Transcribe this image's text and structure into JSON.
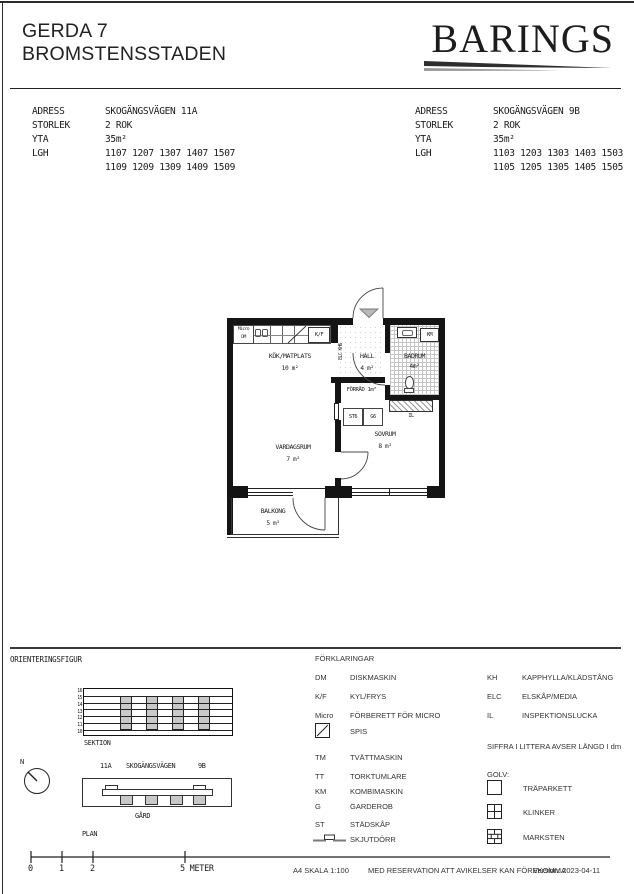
{
  "header": {
    "title_line1": "GERDA 7",
    "title_line2": "BROMSTENSSTADEN",
    "brand": "BARINGS"
  },
  "field_labels": {
    "address": "ADRESS",
    "size": "STORLEK",
    "area": "YTA",
    "apartments": "LGH"
  },
  "units": [
    {
      "address": "SKOGÄNGSVÄGEN 11A",
      "size": "2 ROK",
      "area": "35m²",
      "lgh_row1": "1107 1207 1307 1407 1507",
      "lgh_row2": "1109 1209 1309 1409 1509"
    },
    {
      "address": "SKOGÄNGSVÄGEN 9B",
      "size": "2 ROK",
      "area": "35m²",
      "lgh_row1": "1103 1203 1303 1403 1503",
      "lgh_row2": "1105 1205 1305 1405 1505"
    }
  ],
  "plan": {
    "rooms": [
      {
        "name": "KÖK/MATPLATS",
        "area": "10 m²"
      },
      {
        "name": "HALL",
        "area": "4 m²"
      },
      {
        "name": "BADRUM",
        "area": "4m²"
      },
      {
        "name": "FÖRRÅD",
        "area": "1m²"
      },
      {
        "name": "SOVRUM",
        "area": "8 m²"
      },
      {
        "name": "VARDAGSRUM",
        "area": "7 m²"
      },
      {
        "name": "BALKONG",
        "area": "5 m²"
      }
    ],
    "fixtures": {
      "micro": "Micro",
      "dm": "DM",
      "kf": "K/F",
      "elc_kh": "ELC KH6",
      "km": "KM",
      "st": "ST6",
      "g": "G6",
      "il": "IL"
    }
  },
  "orientation": {
    "title": "ORIENTERINGSFIGUR",
    "sektion_label": "SEKTION",
    "floors": [
      "16",
      "15",
      "14",
      "13",
      "12",
      "11",
      "10"
    ],
    "plan_label": "PLAN",
    "north": "N",
    "street": "SKOGÄNGSVÄGEN",
    "entrance_left": "11A",
    "entrance_right": "9B",
    "yard": "GÅRD"
  },
  "legend": {
    "title": "FÖRKLARINGAR",
    "items_left": [
      {
        "code": "DM",
        "desc": "DISKMASKIN"
      },
      {
        "code": "K/F",
        "desc": "KYL/FRYS"
      },
      {
        "code": "Micro",
        "desc": "FÖRBERETT FÖR MICRO"
      },
      {
        "code": "",
        "desc": "SPIS"
      },
      {
        "code": "TM",
        "desc": "TVÄTTMASKIN"
      },
      {
        "code": "TT",
        "desc": "TORKTUMLARE"
      },
      {
        "code": "KM",
        "desc": "KOMBIMASKIN"
      },
      {
        "code": "G",
        "desc": "GARDEROB"
      },
      {
        "code": "ST",
        "desc": "STÄDSKÅP"
      },
      {
        "code": "",
        "desc": "SKJUTDÖRR"
      }
    ],
    "items_right": [
      {
        "code": "KH",
        "desc": "KAPPHYLLA/KLÄDSTÅNG"
      },
      {
        "code": "ELC",
        "desc": "ELSKÅP/MEDIA"
      },
      {
        "code": "IL",
        "desc": "INSPEKTIONSLUCKA"
      }
    ],
    "note": "SIFFRA I LITTERA AVSER LÄNGD I dm",
    "floor_title": "GOLV:",
    "floor_types": [
      {
        "name": "TRÄPARKETT"
      },
      {
        "name": "KLINKER"
      },
      {
        "name": "MARKSTEN"
      }
    ]
  },
  "footer": {
    "scale_ticks": [
      "0",
      "1",
      "2"
    ],
    "scale_end": "5 METER",
    "scale_text": "A4 SKALA 1:100",
    "disclaimer": "MED RESERVATION ATT AVIKELSER KAN FÖREKOMMA",
    "version": "Version: 2023-04-11"
  },
  "colors": {
    "ink": "#1a1a1a",
    "gray_fill": "#c8c8c8",
    "tile_line": "#c4c4c4"
  }
}
